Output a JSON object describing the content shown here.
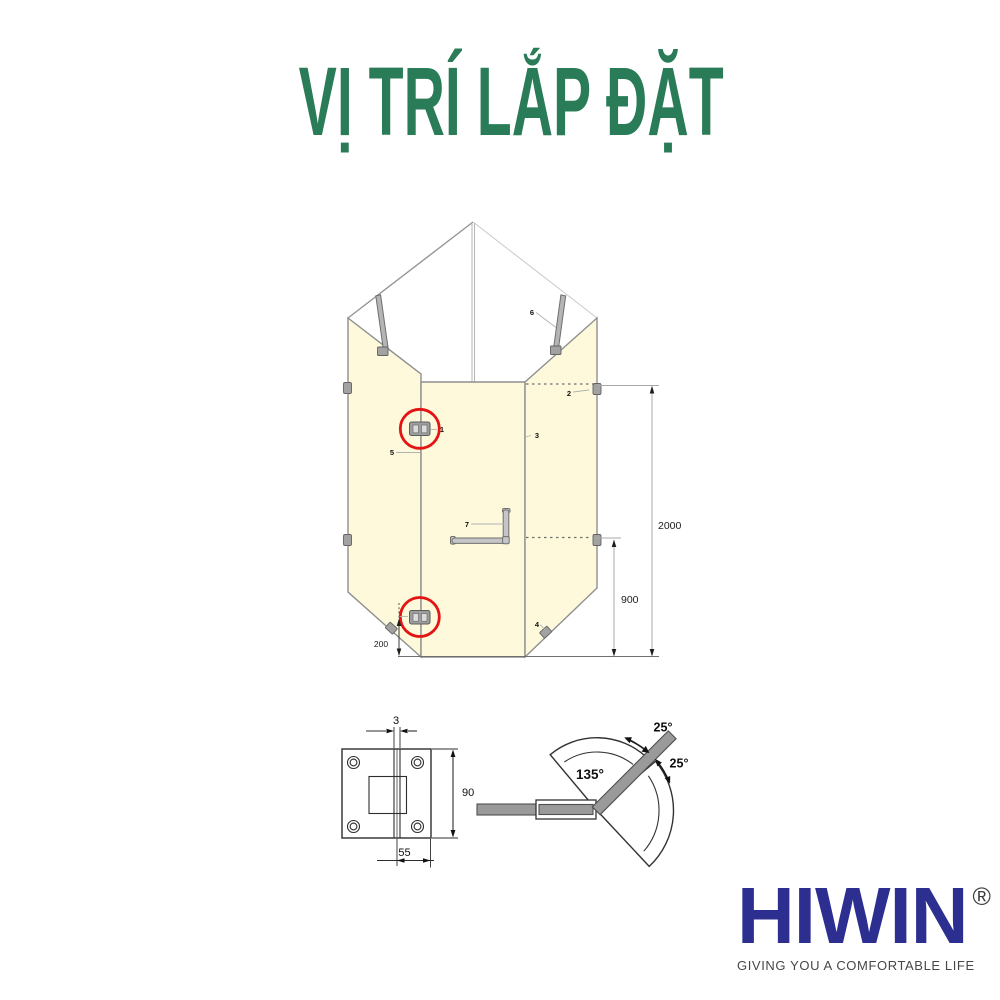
{
  "title": {
    "text": "VỊ TRÍ LẮP ĐẶT"
  },
  "diagram": {
    "part_labels": {
      "p1": "1",
      "p2": "2",
      "p3": "3",
      "p4": "4",
      "p5": "5",
      "p6": "6",
      "p7": "7"
    },
    "dims": {
      "total_height": "2000",
      "handle_height": "900",
      "hinge_offset": "200"
    }
  },
  "hinge_detail": {
    "dims": {
      "gap": "3",
      "height": "90",
      "width": "55"
    }
  },
  "angle_diagram": {
    "open_angle": "135°",
    "swing_upper": "25°",
    "swing_lower": "25°"
  },
  "logo": {
    "brand": "HIWIN",
    "reg": "®",
    "tagline": "GIVING YOU A COMFORTABLE LIFE"
  },
  "colors": {
    "title_green": "#2a7c58",
    "brand_navy": "#2c2f90",
    "highlight_red": "#e41414",
    "glass_yellow": "#fdf9da",
    "tagline_gray": "#47474a"
  }
}
